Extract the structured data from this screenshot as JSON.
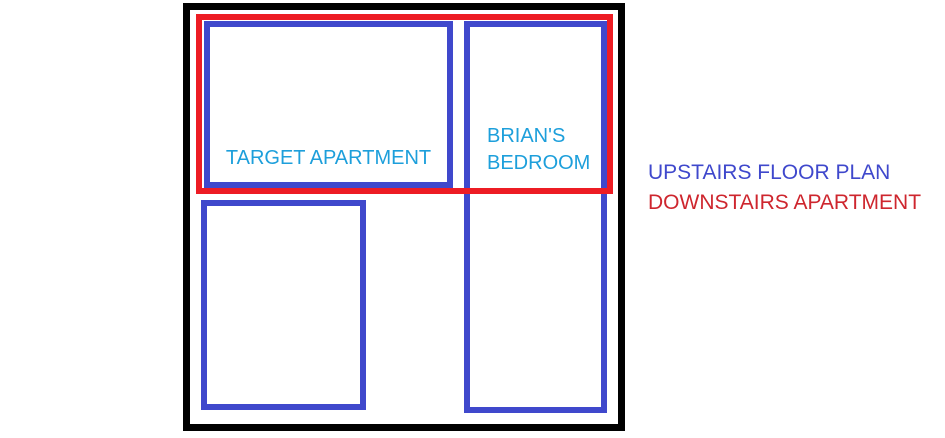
{
  "rooms": {
    "target": {
      "label": "TARGET APARTMENT"
    },
    "brians": {
      "lines": [
        "BRIAN'S",
        "BEDROOM"
      ]
    }
  },
  "legend": {
    "upstairs": {
      "label": "UPSTAIRS FLOOR PLAN",
      "color": "#3F48CC"
    },
    "downstairs": {
      "label": "DOWNSTAIRS APARTMENT",
      "color": "#CE262E"
    }
  },
  "colors": {
    "outline": "#000000",
    "blue_room": "#3F48CC",
    "red_overlay": "#ED1C24",
    "room_label": "#1D9FDB",
    "legend_upstairs": "#3F48CC",
    "legend_downstairs": "#CE262E"
  }
}
